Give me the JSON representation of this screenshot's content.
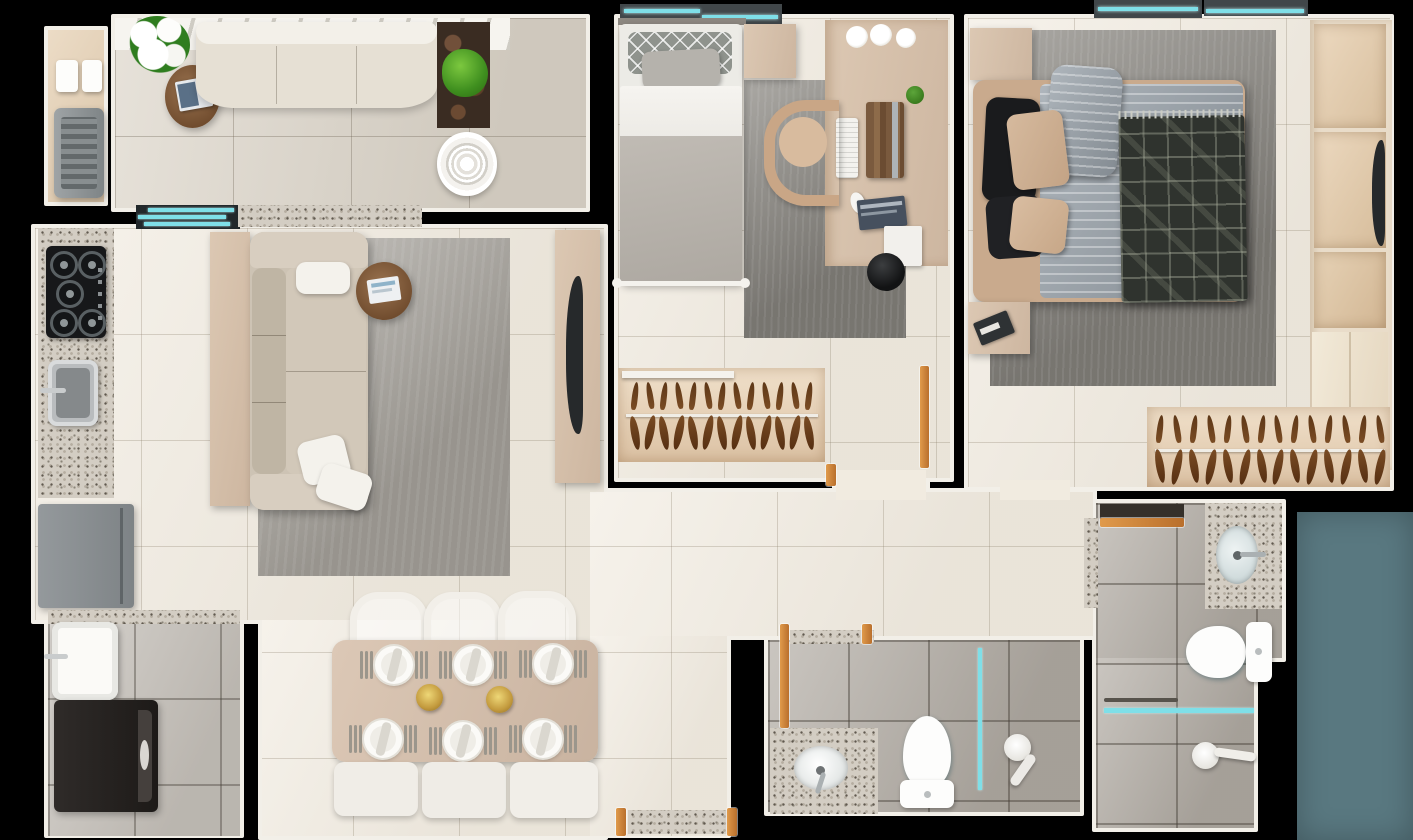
{
  "scene": {
    "type": "apartment-floor-plan-top-view-3d-render",
    "background": "#000000",
    "note": "photoreal top-down floor plan, no visible text labels"
  },
  "palette": {
    "wall_outline": "#f2efe8",
    "floor_cream_tile": "#f1ebe0",
    "floor_balcony_tile": "#dcd5c9",
    "floor_bathroom_tile": "#b3ada5",
    "floor_laundry_tile": "#c6c1ba",
    "closet_wood": "#e6d2b8",
    "furniture_tan": "#d6c1ac",
    "sofa_beige": "#cdc3b4",
    "rug_gray": "#a9a59e",
    "rug_dark_gray": "#8d8a84",
    "glass_cyan": "#7fdfe8",
    "door_wood_orange": "#c07a36",
    "granite_speckle": "#d3cdc3",
    "marble_dark": "#3a2c22",
    "plant_green": "#3f8f1f",
    "appliance_gray": "#8a8f92",
    "appliance_dark": "#2b2725",
    "exterior_teal_block": "#597880",
    "duvet_striped_blue": "#9aa3ab",
    "blanket_plaid_dark": "#2f332e"
  },
  "rooms": [
    {
      "id": "balcony-terrace",
      "furniture": [
        "barbecue-grill",
        "grill-accessories",
        "flower-bouquet",
        "round-coffee-table",
        "book-stack",
        "outdoor-sofa",
        "marble-counter",
        "potted-plant",
        "floor-fan",
        "sliding-glass-door",
        "granite-pass-through"
      ]
    },
    {
      "id": "kitchen",
      "furniture": [
        "granite-counter",
        "gas-cooktop-5-burners",
        "stainless-sink",
        "refrigerator"
      ]
    },
    {
      "id": "living-room",
      "furniture": [
        "sideboard",
        "three-seat-sofa",
        "throw-pillows",
        "area-rug",
        "round-side-table",
        "magazine",
        "tv-panel",
        "television"
      ]
    },
    {
      "id": "dining-room",
      "furniture": [
        "dining-table",
        "chairs",
        "place-settings",
        "flower-centerpieces",
        "bench-cushions"
      ]
    },
    {
      "id": "laundry-area",
      "furniture": [
        "granite-ledge",
        "utility-tub",
        "washing-machine"
      ]
    },
    {
      "id": "bedroom-single",
      "furniture": [
        "single-bed",
        "patterned-pillow",
        "gray-pillow",
        "blanket",
        "nightstand",
        "concrete-rug",
        "built-in-desk",
        "desk-chair",
        "keyboard",
        "book-organizer",
        "small-plant",
        "mouse",
        "book-stack",
        "storage-box",
        "white-flowers",
        "black-pouf",
        "closet-with-hangers",
        "wood-door",
        "window"
      ]
    },
    {
      "id": "bedroom-double",
      "furniture": [
        "double-bed",
        "striped-duvet",
        "striped-pillow",
        "plaid-blanket",
        "black-pillows",
        "tan-pillows",
        "nightstand-top",
        "nightstand-side",
        "book",
        "area-rug-dark",
        "wardrobe-shelving",
        "television",
        "closet-with-hangers",
        "windows",
        "wood-door"
      ]
    },
    {
      "id": "bathroom-main",
      "furniture": [
        "granite-vanity",
        "oval-sink",
        "faucet",
        "toilet",
        "glass-shower-partition",
        "shower-head",
        "wood-door",
        "granite-threshold"
      ]
    },
    {
      "id": "bathroom-suite",
      "furniture": [
        "granite-vanity",
        "oval-sink",
        "faucet",
        "toilet",
        "towel-bar",
        "glass-shower-partition",
        "shower-head",
        "wood-door",
        "granite-door-jamb"
      ]
    },
    {
      "id": "hallway",
      "furniture": []
    },
    {
      "id": "entry-corridor",
      "furniture": [
        "entry-door-threshold",
        "door-jambs"
      ]
    },
    {
      "id": "exterior-teal-block",
      "furniture": []
    }
  ],
  "generate": {
    "closet_single_hangers": 13,
    "closet_double_hangers": 14,
    "dining_place_settings": 6,
    "dining_chairs_top": 3,
    "dining_bench_cushions": 3,
    "cooktop_burners": 5,
    "desk_white_flowers": 3,
    "dining_centerpieces": 2
  }
}
